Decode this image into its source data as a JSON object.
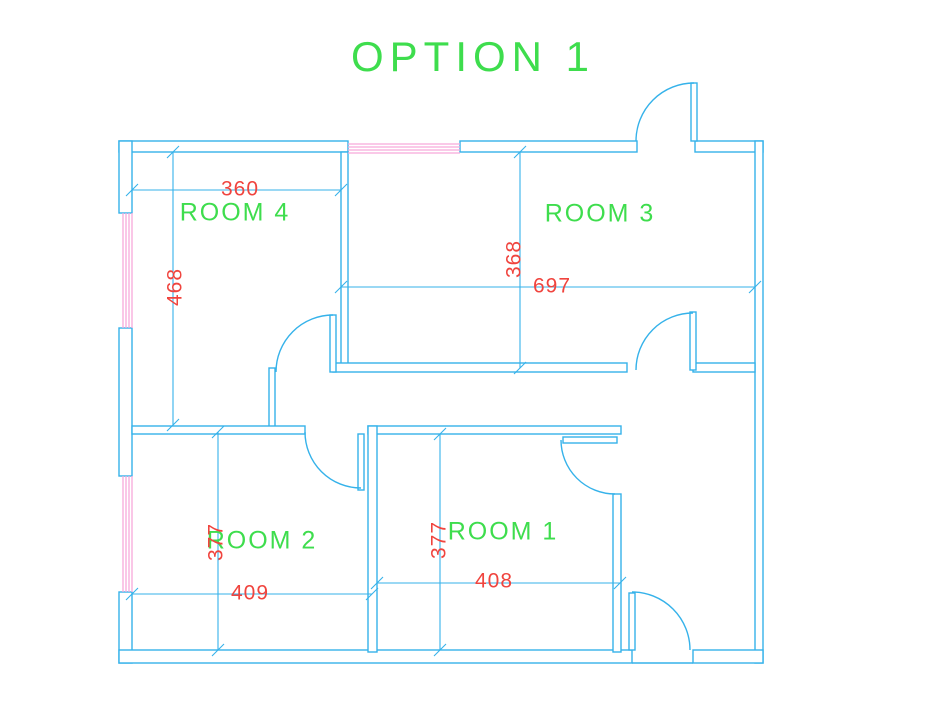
{
  "title": "OPTION 1",
  "colors": {
    "wall_line": "#35b2ea",
    "window_hatch": "#f8a9da",
    "room_label_green": "#3edd4d",
    "dimension_red": "#f0443e"
  },
  "rooms": {
    "room1": {
      "label": "ROOM 1",
      "width": "408",
      "height": "377"
    },
    "room2": {
      "label": "ROOM 2",
      "width": "409",
      "height": "377"
    },
    "room3": {
      "label": "ROOM 3",
      "width": "697",
      "height": "368"
    },
    "room4": {
      "label": "ROOM 4",
      "width": "360",
      "height": "468"
    }
  },
  "features": {
    "windows": [
      "left-upper-window",
      "left-lower-window",
      "top-window"
    ],
    "doors": [
      "entrance-door-top",
      "room3-door",
      "room4-door",
      "room2-door",
      "room1-door",
      "exit-door-bottom"
    ]
  }
}
